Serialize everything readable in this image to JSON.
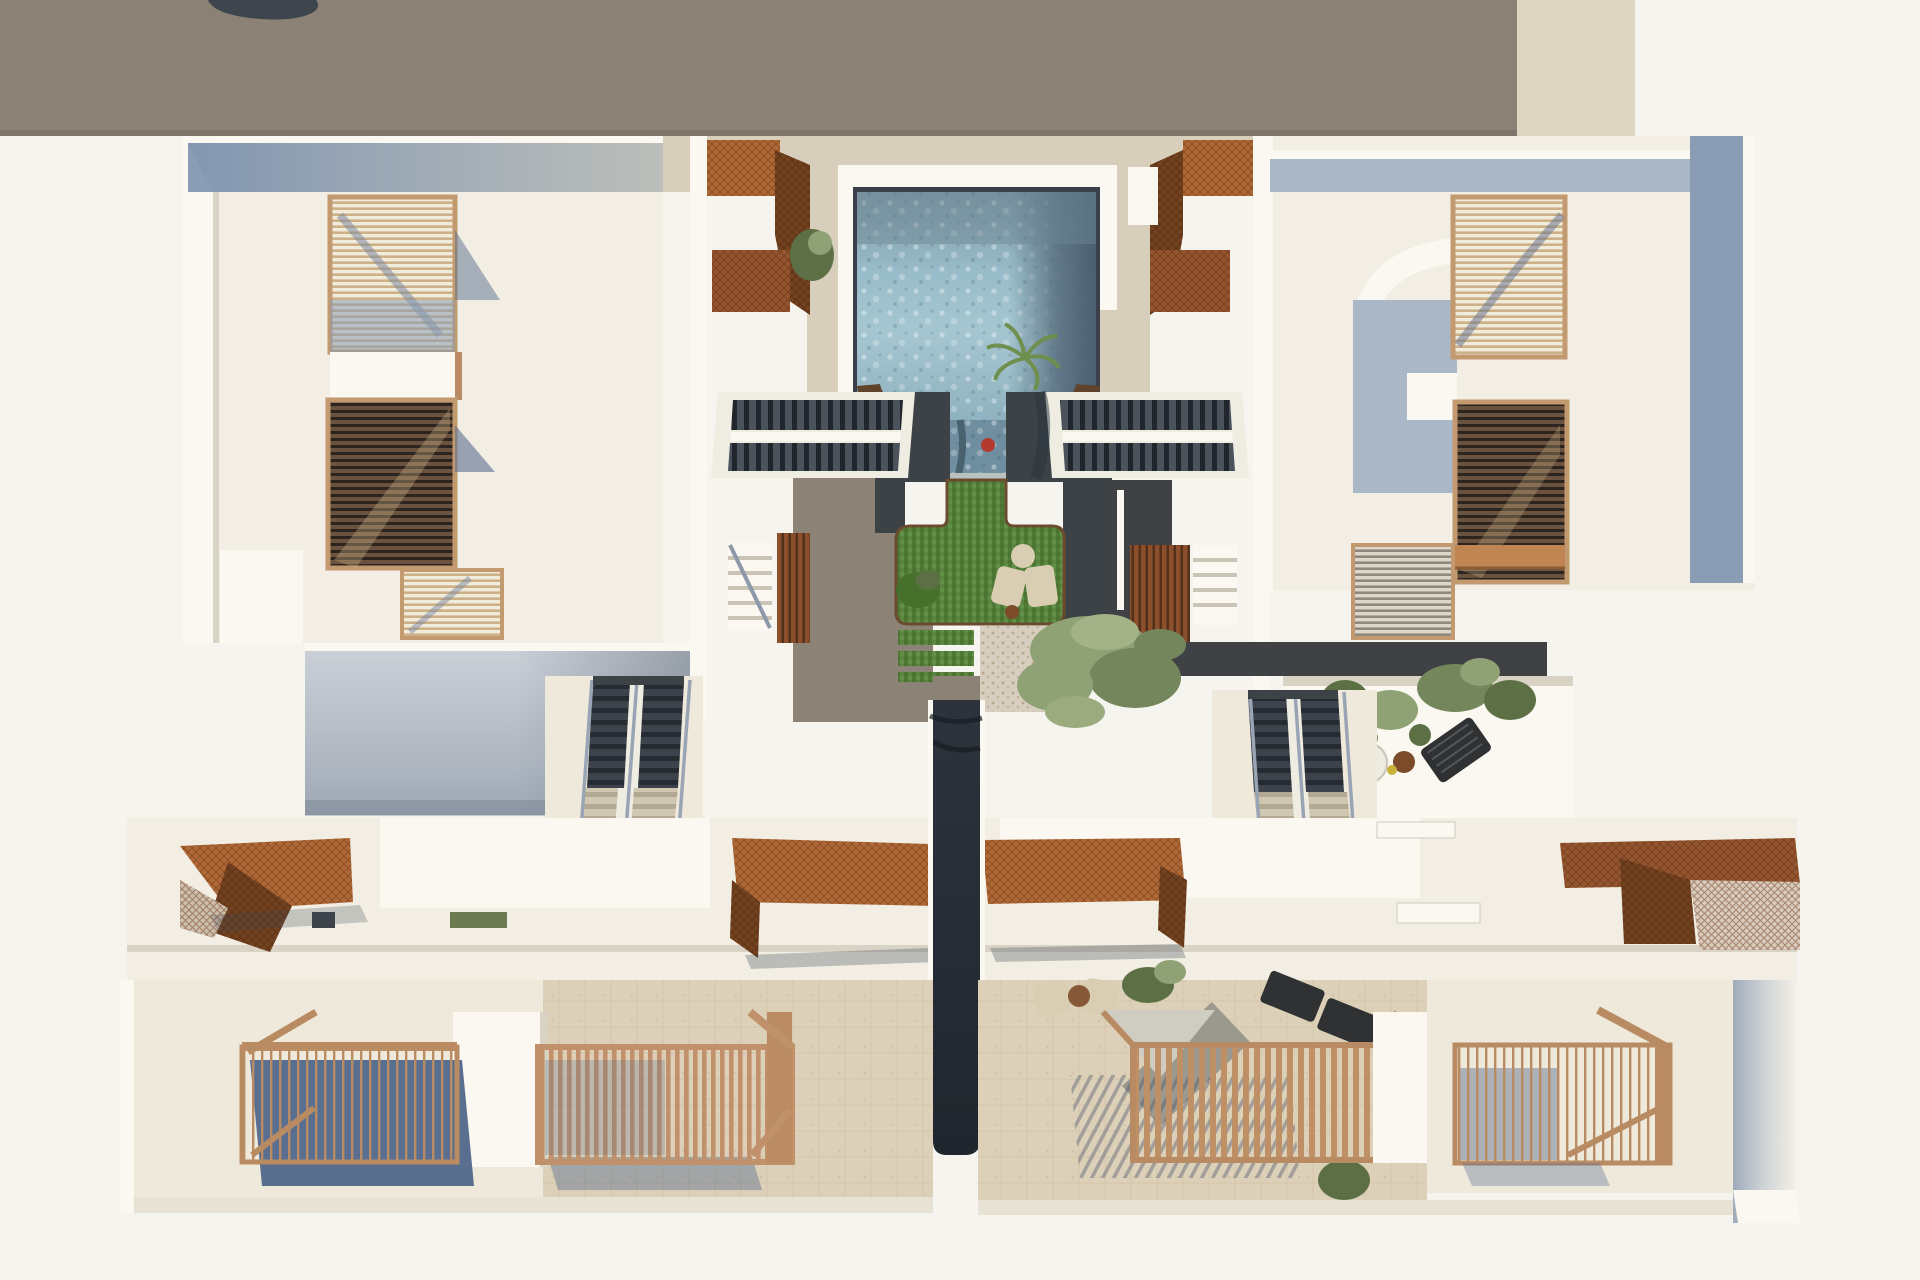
{
  "scene": {
    "label": "aerial-top-view-3d-render-of-residential-complex",
    "elements": {
      "neighbor_roof": "adjacent-flat-roof",
      "upper_blocks": [
        "left-apartment-block",
        "right-apartment-block"
      ],
      "balcony_screens_per_block": 3,
      "courtyard": [
        "swimming-pool",
        "lawn-island",
        "lawn-steps",
        "pebble-patio",
        "twin-courtyard-stairs",
        "corten-stair-screens",
        "olive-tree",
        "palm-plant"
      ],
      "mid_level": [
        "shaded-south-facade",
        "long-stairway-left",
        "long-stairway-right",
        "roof-terrace-with-plants",
        "round-table",
        "sun-lounger"
      ],
      "lower_row": [
        "corten-canopy-far-left",
        "corten-canopy-center-left",
        "corten-canopy-center-right",
        "corten-canopy-far-right",
        "central-corridor",
        "railed-terrace-1",
        "railed-terrace-2",
        "slatted-pergola-terrace",
        "railed-terrace-3"
      ],
      "furniture": [
        "beige-armchairs",
        "black-sun-loungers",
        "lounge-chairs",
        "potted-plants"
      ]
    },
    "counts": {
      "corten_canopies": 4,
      "railing_boxes": 3,
      "stairways": 4,
      "trees": 1
    }
  },
  "palette": {
    "bg": "#f6f4ef",
    "neighbor-roof": "#8b8275",
    "neighbor-roof-edge": "#776e62",
    "roof-object": "#3e454c",
    "beige-strip": "#ded6c2",
    "cream": "#f2eee3",
    "cream-bright": "#faf8f1",
    "cream-dim": "#e7e2d4",
    "wall-white": "#f5f2ea",
    "shadow-warm": "#d8d3c5",
    "parapet-blue": "#8b9db5",
    "parapet-blue-light": "#aab7c7",
    "facade-blue-top": "#ccd1d8",
    "facade-blue-bottom": "#9ea7b3",
    "walkway-beige": "#d7cfbc",
    "stone-floor": "#dcd0b8",
    "terrace-cream": "#efe9db",
    "pebble": "#d8cec0",
    "charcoal": "#3d4247",
    "corridor-dark": "#262c34",
    "path-taupe": "#8c8376",
    "paver-dark": "#3f4145",
    "pool-rim": "#39404a",
    "water-top": "#7e97a5",
    "water-mid": "#98bcc9",
    "water-light": "#a5c6d1",
    "water-dark": "#566c7c",
    "water-tongue": "#6f8fa0",
    "red-float": "#b23a30",
    "corten-bright": "#b16835",
    "corten-mid": "#96552e",
    "corten-dark": "#74421f",
    "planter-brown": "#5f432b",
    "wood-frame": "#bb8c64",
    "wood-slat": "#c49a70",
    "grass-a": "#55803a",
    "grass-b": "#6b9a4e",
    "grass-dark": "#46702c",
    "stringer": "#efece2",
    "tread-light": "#c3b9a4",
    "tree-green": "#8fa275",
    "tree-green-dark": "#74875c",
    "plant-green": "#5d7045",
    "furniture-beige": "#d9cdb2",
    "furniture-dark": "#2f3133",
    "shadow-blue": "#5a6e8f",
    "shadow-soft": "#3c4654",
    "table-wood": "#7b4b2a",
    "mat-gray": "#858780",
    "awning-gray": "#cfccc2"
  }
}
